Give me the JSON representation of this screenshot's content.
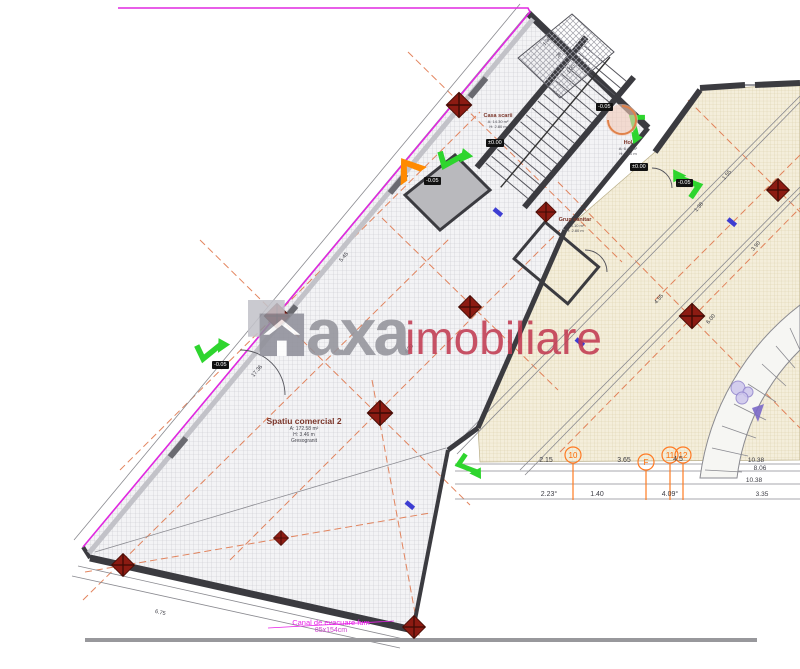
{
  "watermark": {
    "brand_primary": "axa",
    "brand_secondary": "imobiliare",
    "accent_color": "#c23b52",
    "logo_color": "#90909a"
  },
  "rooms": [
    {
      "name": "Casa scarii",
      "line1": "A: 14.30 m²",
      "line2": "H: 2.80 m",
      "line3": ""
    },
    {
      "name": "Hol",
      "line1": "A: 6.42 m²",
      "line2": "H: 2.80 m",
      "line3": ""
    },
    {
      "name": "Grup sanitar",
      "line1": "A: 3.10 m²",
      "line2": "H: 2.80 m",
      "line3": ""
    },
    {
      "name": "Spatiu comercial 2",
      "line1": "A: 172.58 m²",
      "line2": "H: 3.46 m",
      "line3": "Gresogranit"
    }
  ],
  "elevations": [
    "±0.00",
    "-0.05",
    "±0.00",
    "-0.05",
    "-0.05",
    "-0.05"
  ],
  "grid_bubbles": [
    "10",
    "F",
    "11",
    "12"
  ],
  "notes": {
    "flue": "Canal de evacuare fum",
    "flue_size": "85x154cm"
  },
  "dims": {
    "row_top": [
      "2.15",
      "3.65",
      "4.5"
    ],
    "col_right": [
      "10.38",
      "8.06",
      "10.38",
      "3.35"
    ],
    "row_bottom": [
      "2.23°",
      "1.40",
      "4.09°"
    ],
    "edge": [
      "17.36",
      "4.20",
      "5.45",
      "1.30",
      "26",
      "1.20",
      "1.38",
      "1.55",
      "3.90",
      "4.55",
      "6.00",
      "6.75"
    ]
  },
  "colors": {
    "boundary_magenta": "#e028e0",
    "axis_dash_orange": "#e0784e",
    "column_red": "#8c1b12",
    "arrow_green": "#2ed52e",
    "arrow_orange": "#ff8a00",
    "bubble_orange": "#ff7a22",
    "zone_gray": "#f3f3f5",
    "zone_beige": "#f4eedb"
  }
}
